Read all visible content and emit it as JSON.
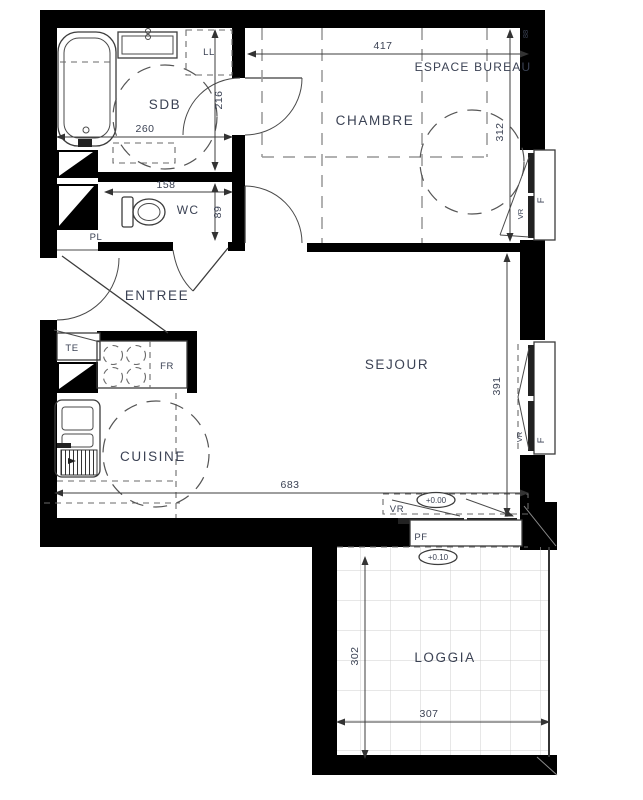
{
  "plan": {
    "type": "apartment-floor-plan",
    "rooms": {
      "sdb": "SDB",
      "wc": "WC",
      "entree": "ENTREE",
      "chambre": "CHAMBRE",
      "espace_bureau": "ESPACE BUREAU",
      "sejour": "SEJOUR",
      "cuisine": "CUISINE",
      "loggia": "LOGGIA"
    },
    "dims": {
      "sdb_width": "260",
      "sdb_height": "216",
      "wc_width": "158",
      "wc_height": "89",
      "chambre_width": "417",
      "chambre_height": "312",
      "sejour_width": "683",
      "sejour_height": "391",
      "loggia_width": "307",
      "loggia_height": "302",
      "corner": "88"
    },
    "fixtures": {
      "washing_machine": "LL",
      "closet": "PL",
      "electrical_panel": "TE",
      "fridge": "FR",
      "window": "F",
      "roller_shutter": "VR",
      "french_window": "PF"
    },
    "levels": {
      "main_floor": "+0.00",
      "loggia": "+0.10"
    },
    "colors": {
      "wall": "#000000",
      "line": "#3c3c3c",
      "text": "#3b4254",
      "dash": "#979797",
      "grid": "#cfcfcf"
    }
  }
}
